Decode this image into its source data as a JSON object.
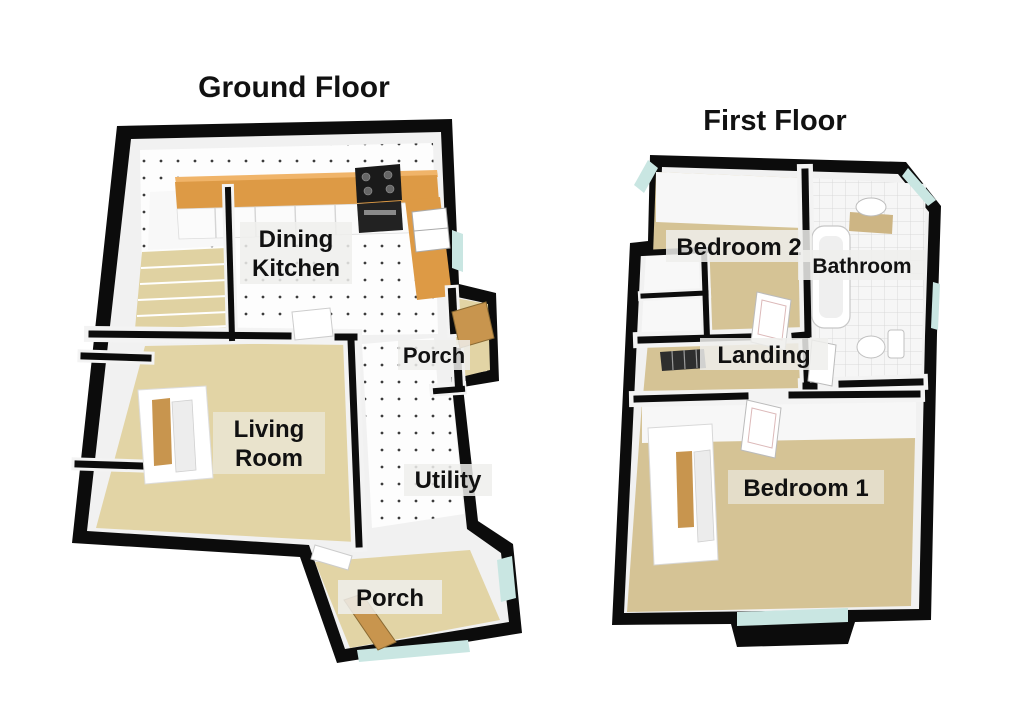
{
  "floors": {
    "ground": {
      "title": "Ground Floor",
      "rooms": {
        "dining_kitchen": {
          "line1": "Dining",
          "line2": "Kitchen"
        },
        "porch_side": {
          "label": "Porch"
        },
        "living_room": {
          "line1": "Living",
          "line2": "Room"
        },
        "utility": {
          "label": "Utility"
        },
        "porch_front": {
          "label": "Porch"
        }
      }
    },
    "first": {
      "title": "First Floor",
      "rooms": {
        "bedroom2": {
          "label": "Bedroom 2"
        },
        "bathroom": {
          "label": "Bathroom"
        },
        "landing": {
          "label": "Landing"
        },
        "bedroom1": {
          "label": "Bedroom 1"
        }
      }
    }
  },
  "colors": {
    "background": "#ffffff",
    "wall": "#0c0c0c",
    "wall_face": "#f1f1f1",
    "far_wall_face": "#f7f7f7",
    "carpet_light": "#e2d4a5",
    "carpet_dark": "#d5c395",
    "tile_floor": "#fdfdfd",
    "tile_dot": "#3c3c3c",
    "bath_tile": "#f6f6f6",
    "bath_tile_line": "#d9d9d9",
    "counter_wood": "#dd9a45",
    "counter_wood_light": "#f0b469",
    "door_wood": "#c8954e",
    "appliance_dark": "#1a1a1a",
    "cabinet_front": "#fbfbfb",
    "glass": "#c9e6e2",
    "fixture_white": "#ffffff",
    "fixture_stroke": "#b5b5b5",
    "stairs": "#e0d2a2",
    "stairwell_dark": "#2e2e2e",
    "label_bg": "#efefec",
    "label_text": "#111111",
    "title_text": "#111111"
  }
}
